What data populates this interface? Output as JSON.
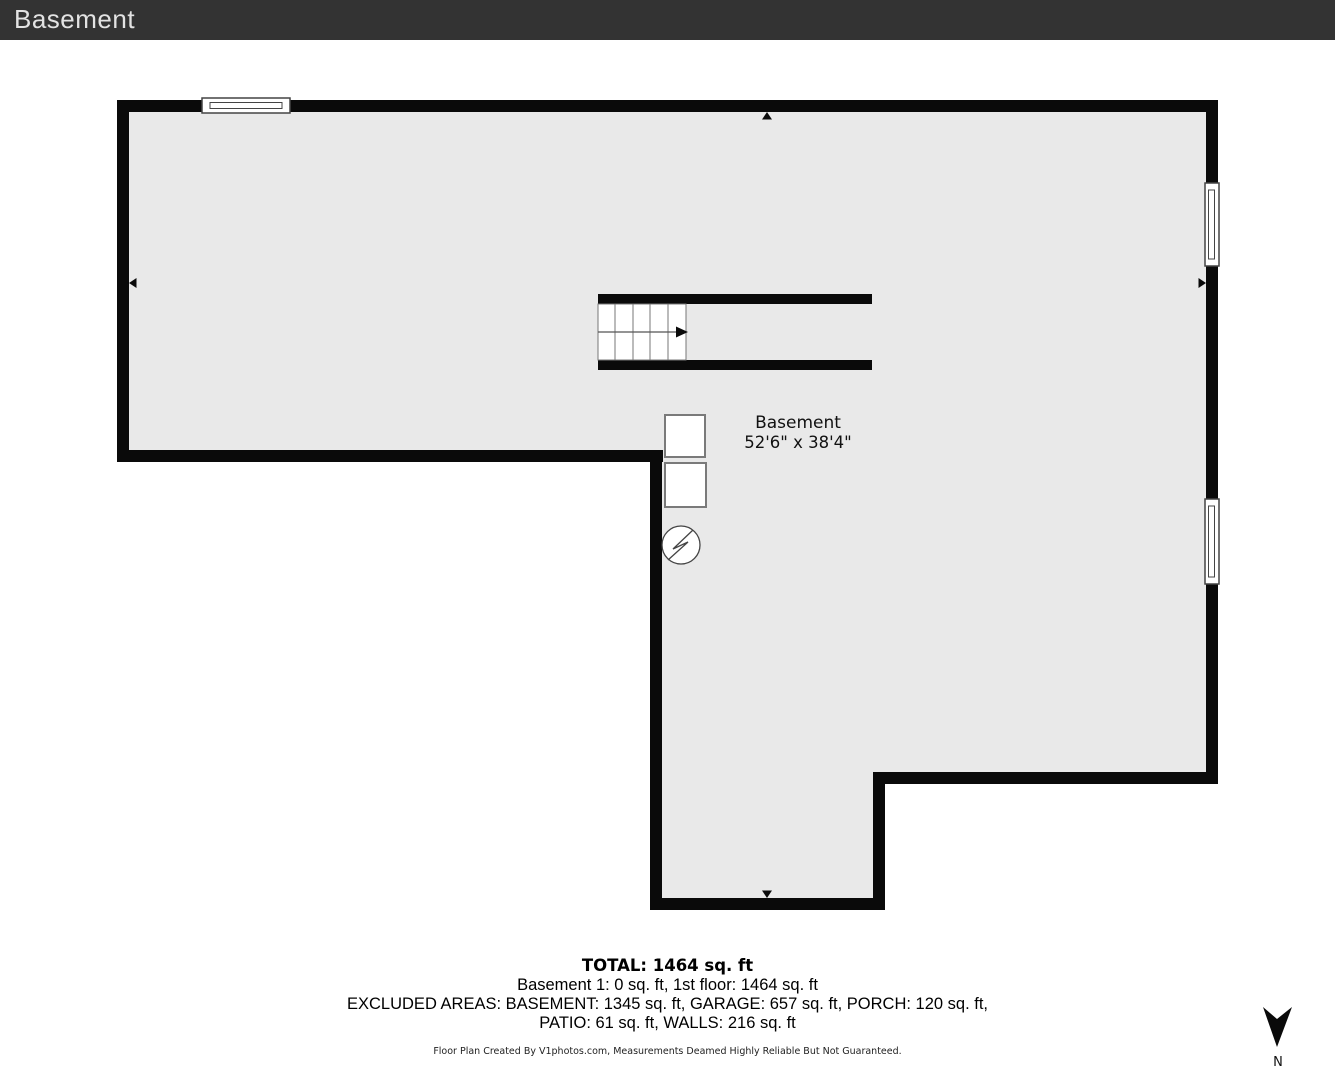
{
  "header": {
    "title": "Basement"
  },
  "plan": {
    "room_label": {
      "name": "Basement",
      "dimensions": "52'6\" x 38'4\""
    },
    "colors": {
      "wall": "#0a0a0a",
      "floor": "#e9e9e9",
      "window_stroke": "#444444",
      "square_stroke": "#7a7a7a"
    }
  },
  "summary": {
    "total": "TOTAL: 1464 sq. ft",
    "line2": "Basement 1: 0 sq. ft, 1st floor: 1464 sq. ft",
    "line3": "EXCLUDED AREAS: BASEMENT: 1345 sq. ft, GARAGE: 657 sq. ft, PORCH: 120 sq. ft,",
    "line4": "PATIO: 61 sq. ft, WALLS: 216 sq. ft",
    "disclaimer": "Floor Plan Created By V1photos.com, Measurements Deamed Highly Reliable But Not Guaranteed."
  },
  "compass": {
    "label": "N"
  }
}
